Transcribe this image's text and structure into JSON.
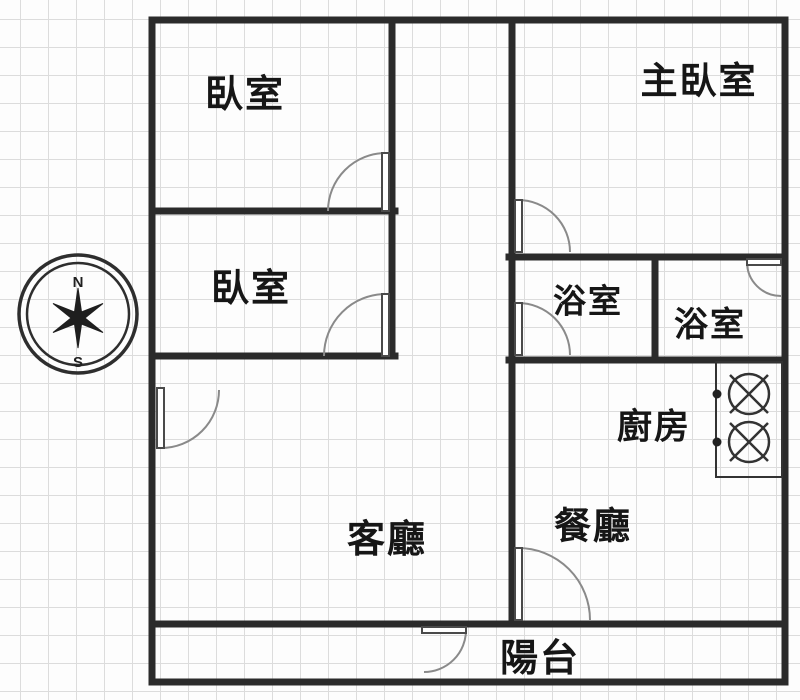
{
  "page": {
    "type": "apartment-floor-plan",
    "background": "graph-paper"
  },
  "rooms": {
    "bedroom_top_left": {
      "label": "臥室"
    },
    "master_bedroom": {
      "label": "主臥室"
    },
    "bedroom_mid_left": {
      "label": "臥室"
    },
    "bathroom_left": {
      "label": "浴室"
    },
    "bathroom_right": {
      "label": "浴室"
    },
    "kitchen": {
      "label": "廚房"
    },
    "living_room": {
      "label": "客廳"
    },
    "dining_room": {
      "label": "餐廳"
    },
    "balcony": {
      "label": "陽台"
    }
  },
  "compass": {
    "north_label": "N",
    "south_label": "S"
  },
  "icons": {
    "compass": "compass-rose-icon",
    "stove": "stove-two-burner-icon",
    "door": "door-swing-icon"
  },
  "colors": {
    "wall": "#2b2b2b",
    "grid_line": "#dcdcdc",
    "paper": "#fdfdfd",
    "door_arc": "#8a8a8a",
    "text": "#161616"
  }
}
